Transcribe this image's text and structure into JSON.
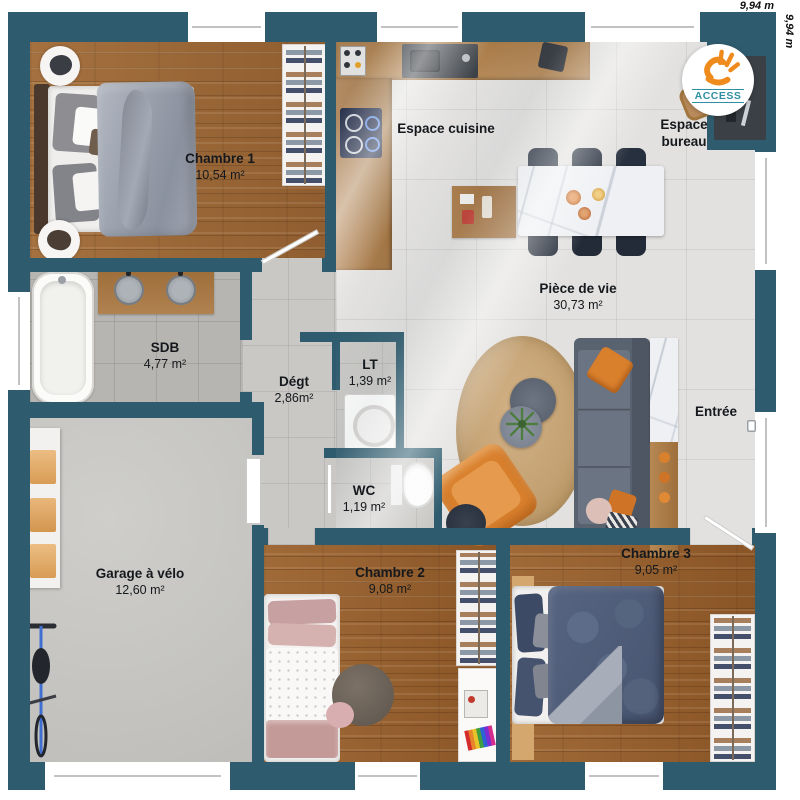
{
  "dimensions": {
    "top": "9,94 m",
    "right": "9,94 m"
  },
  "logo": {
    "text": "ACCESS"
  },
  "rooms": {
    "chambre1": {
      "name": "Chambre 1",
      "area": "10,54 m²"
    },
    "cuisine": {
      "name": "Espace cuisine"
    },
    "bureau": {
      "line1": "Espace",
      "line2": "bureau"
    },
    "piece_de_vie": {
      "name": "Pièce de vie",
      "area": "30,73 m²"
    },
    "sdb": {
      "name": "SDB",
      "area": "4,77 m²"
    },
    "degt": {
      "name": "Dégt",
      "area": "2,86m²"
    },
    "lt": {
      "name": "LT",
      "area": "1,39 m²"
    },
    "wc": {
      "name": "WC",
      "area": "1,19 m²"
    },
    "entree": {
      "name": "Entrée"
    },
    "garage": {
      "name": "Garage à vélo",
      "area": "12,60 m²"
    },
    "chambre2": {
      "name": "Chambre 2",
      "area": "9,08 m²"
    },
    "chambre3": {
      "name": "Chambre 3",
      "area": "9,05 m²"
    }
  },
  "colors": {
    "wall": "#2e5c6e",
    "accent": "#d9802d",
    "logo_teal": "#2f8fa3",
    "logo_orange": "#ef8b1d"
  }
}
